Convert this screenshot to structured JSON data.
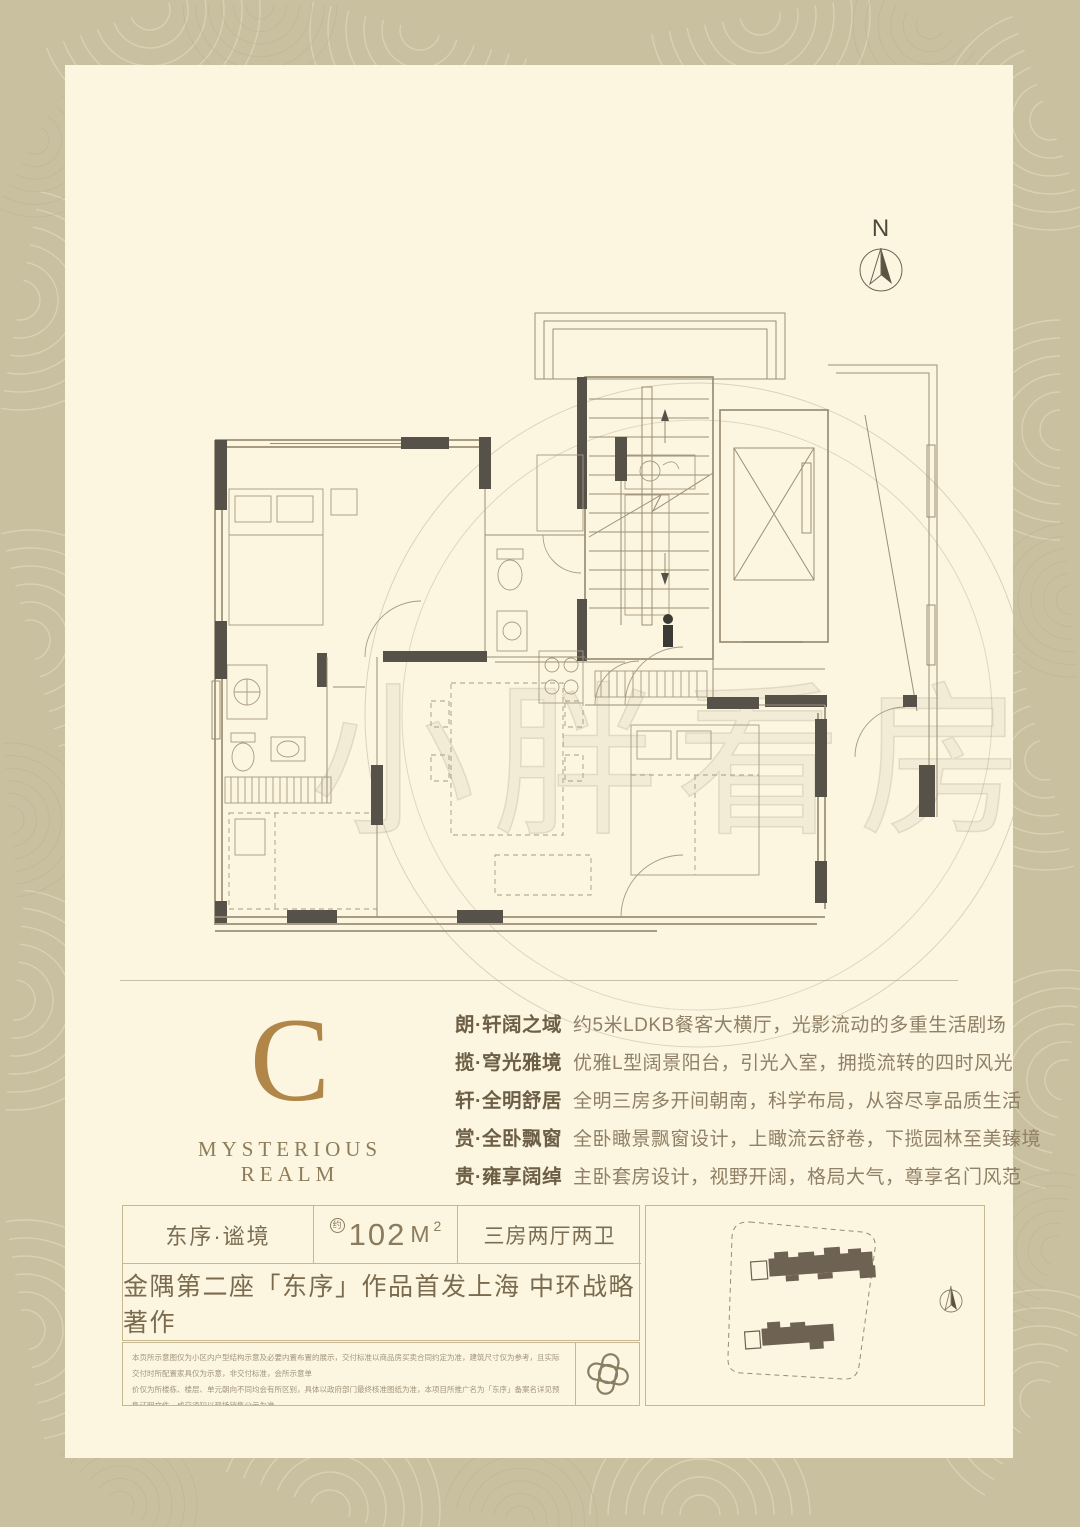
{
  "poster": {
    "compass_label": "N",
    "watermark": "小胖看房",
    "type_letter": "C",
    "type_subtitle": "MYSTERIOUS REALM"
  },
  "features": [
    {
      "title": "朗·轩阔之域",
      "desc": "约5米LDKB餐客大横厅，光影流动的多重生活剧场"
    },
    {
      "title": "揽·穹光雅境",
      "desc": "优雅L型阔景阳台，引光入室，拥揽流转的四时风光"
    },
    {
      "title": "轩·全明舒居",
      "desc": "全明三房多开间朝南，科学布局，从容尽享品质生活"
    },
    {
      "title": "赏·全卧飘窗",
      "desc": "全卧瞰景飘窗设计，上瞰流云舒卷，下揽园林至美臻境"
    },
    {
      "title": "贵·雍享阔绰",
      "desc": "主卧套房设计，视野开阔，格局大气，尊享名门风范"
    }
  ],
  "info": {
    "unit_name": "东序·谧境",
    "area_approx": "约",
    "area_number": "102",
    "area_unit": "M",
    "area_sup": "2",
    "layout": "三房两厅两卫",
    "tagline": "金隅第二座「东序」作品首发上海 中环战略著作"
  },
  "disclaimer": {
    "line1": "本页所示意图仅为小区内户型结构示意及必要内置布置的展示，交付标准以商品房买卖合同约定为准，建筑尺寸仅为参考，且实际交付时所配置家具仅为示意，非交付标准，会所示意单",
    "line2": "价仅为所楼栋、楼层、单元朝向不同均会有所区别，具体以政府部门最终核准图纸为准，本项目所推广名为「东序」备案名详见预售证明文件，成交须知以现场销售公示为准，",
    "line3": "相关文本内容、户型结构、面积信息仅供参考请以商品房买卖合同及政府最终核准文件约定为准。本广告发布时间为2025年2月，有效期至2025年12月31日。"
  },
  "colors": {
    "card": "#fcf6e1",
    "frame": "#c9c0a0",
    "gold": "#b08748",
    "ink": "#7c6e52",
    "wall": "#56524a",
    "line": "#9b8e74"
  }
}
